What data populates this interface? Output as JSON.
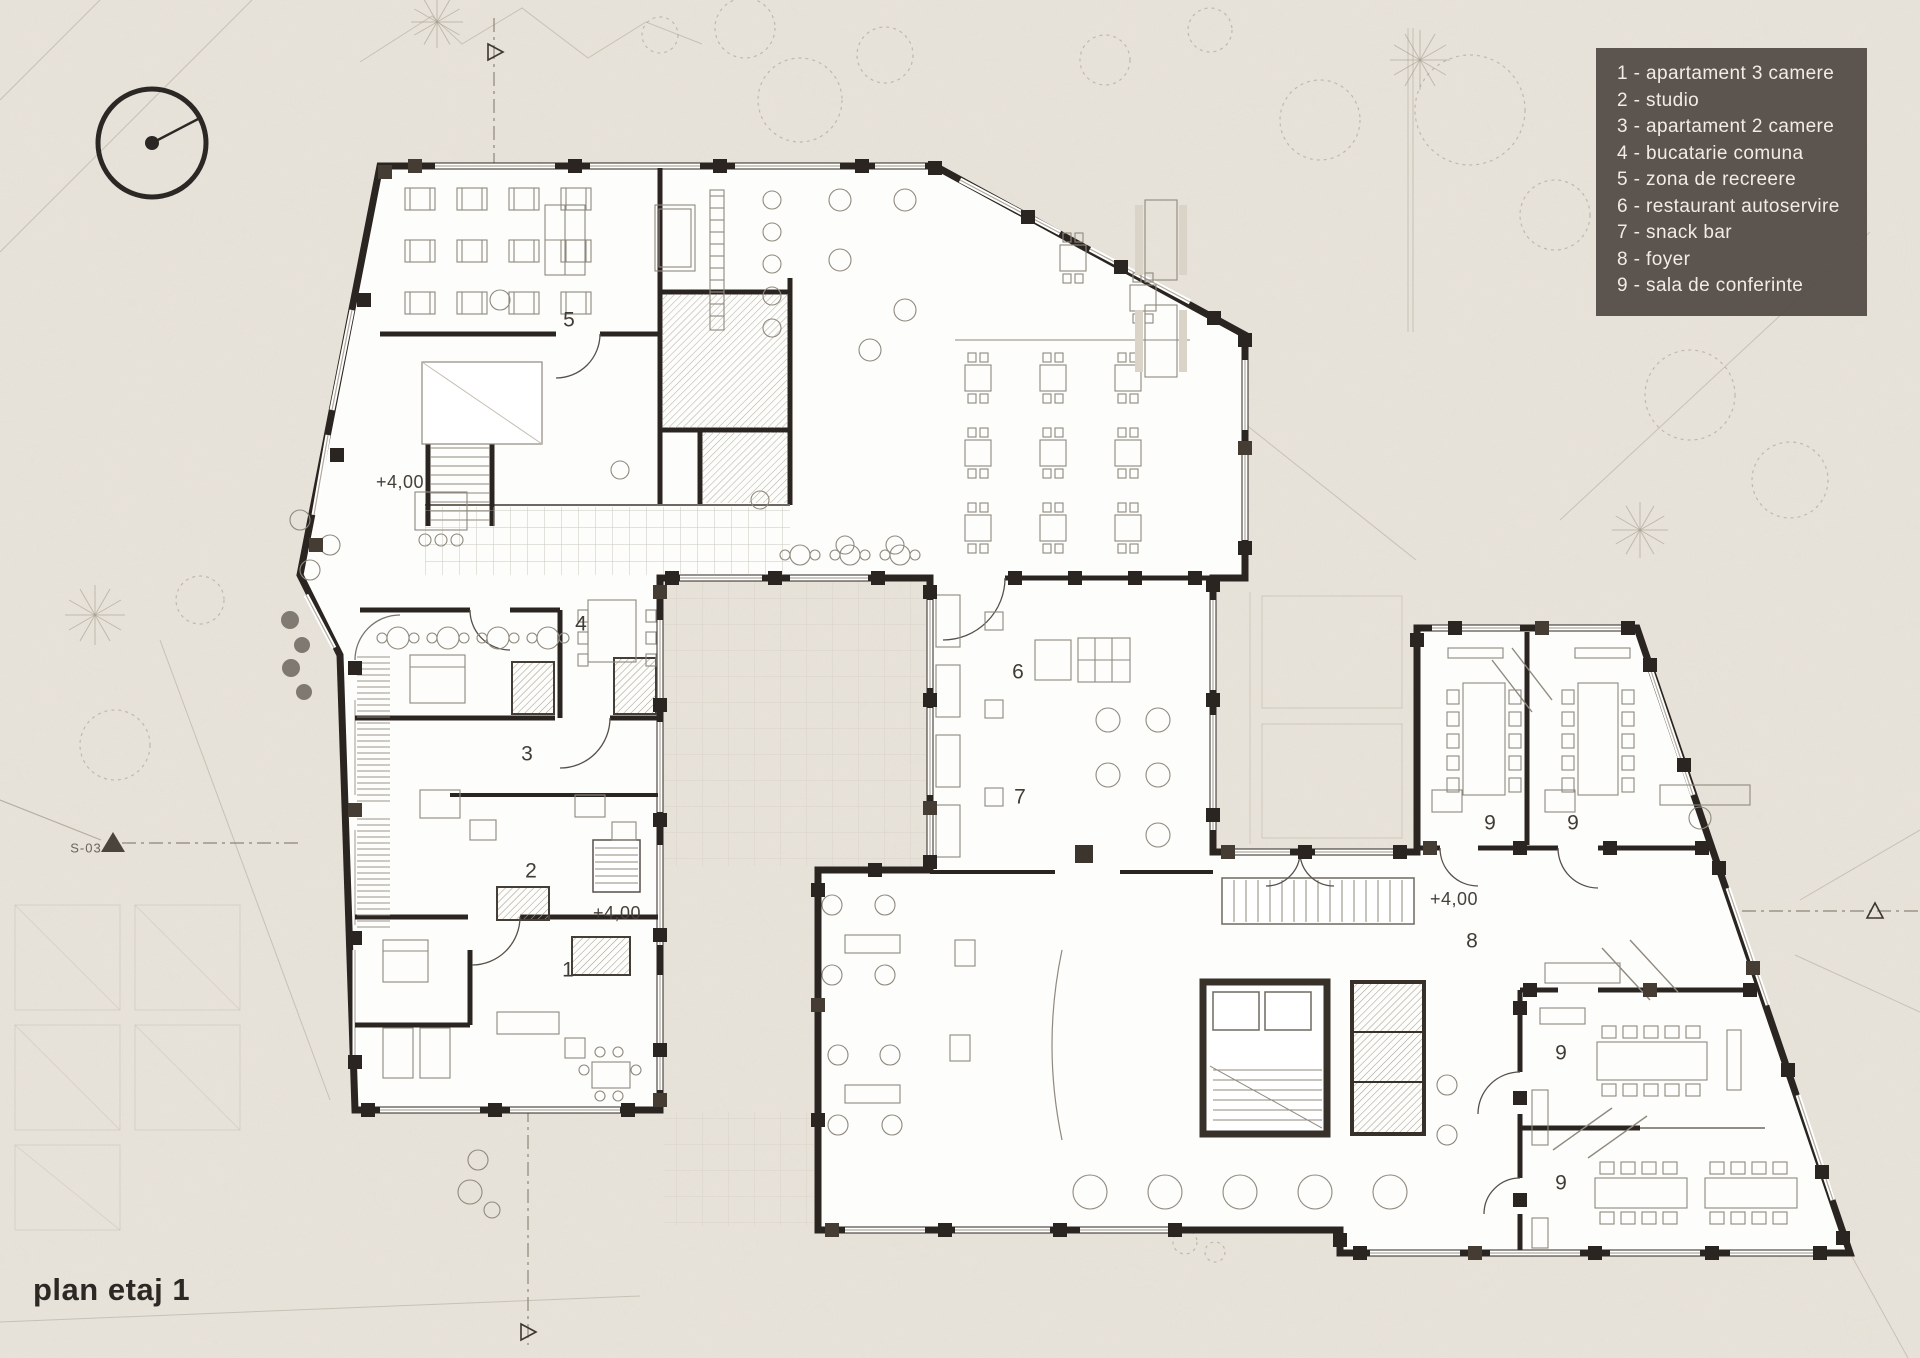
{
  "page": {
    "title": "plan etaj 1"
  },
  "legend": {
    "items": [
      "1 - apartament 3 camere",
      "2 - studio",
      "3 - apartament 2 camere",
      "4 - bucatarie comuna",
      "5 - zona de recreere",
      "6 - restaurant autoservire",
      "7 - snack bar",
      "8 - foyer",
      "9 - sala de conferinte"
    ]
  },
  "plan": {
    "room_labels": [
      {
        "label": "5",
        "x": 569,
        "y": 320
      },
      {
        "label": "4",
        "x": 581,
        "y": 624
      },
      {
        "label": "3",
        "x": 527,
        "y": 754
      },
      {
        "label": "2",
        "x": 531,
        "y": 871
      },
      {
        "label": "1",
        "x": 568,
        "y": 970
      },
      {
        "label": "6",
        "x": 1018,
        "y": 672
      },
      {
        "label": "7",
        "x": 1020,
        "y": 797
      },
      {
        "label": "8",
        "x": 1472,
        "y": 941
      },
      {
        "label": "9",
        "x": 1490,
        "y": 823
      },
      {
        "label": "9",
        "x": 1573,
        "y": 823
      },
      {
        "label": "9",
        "x": 1561,
        "y": 1053
      },
      {
        "label": "9",
        "x": 1561,
        "y": 1183
      }
    ],
    "elevation_labels": [
      {
        "label": "+4,00",
        "x": 400,
        "y": 482
      },
      {
        "label": "+4,00",
        "x": 617,
        "y": 913
      },
      {
        "label": "+4,00",
        "x": 1454,
        "y": 899
      }
    ],
    "section_labels": [
      {
        "label": "S-03",
        "x": 86,
        "y": 848
      }
    ]
  },
  "colors": {
    "paper": "#e9e4db",
    "wall": "#2b2521",
    "legend_bg": "#575049",
    "legend_text": "#f1ede6",
    "furniture_line": "#8f897e",
    "label_text": "#413c35"
  }
}
